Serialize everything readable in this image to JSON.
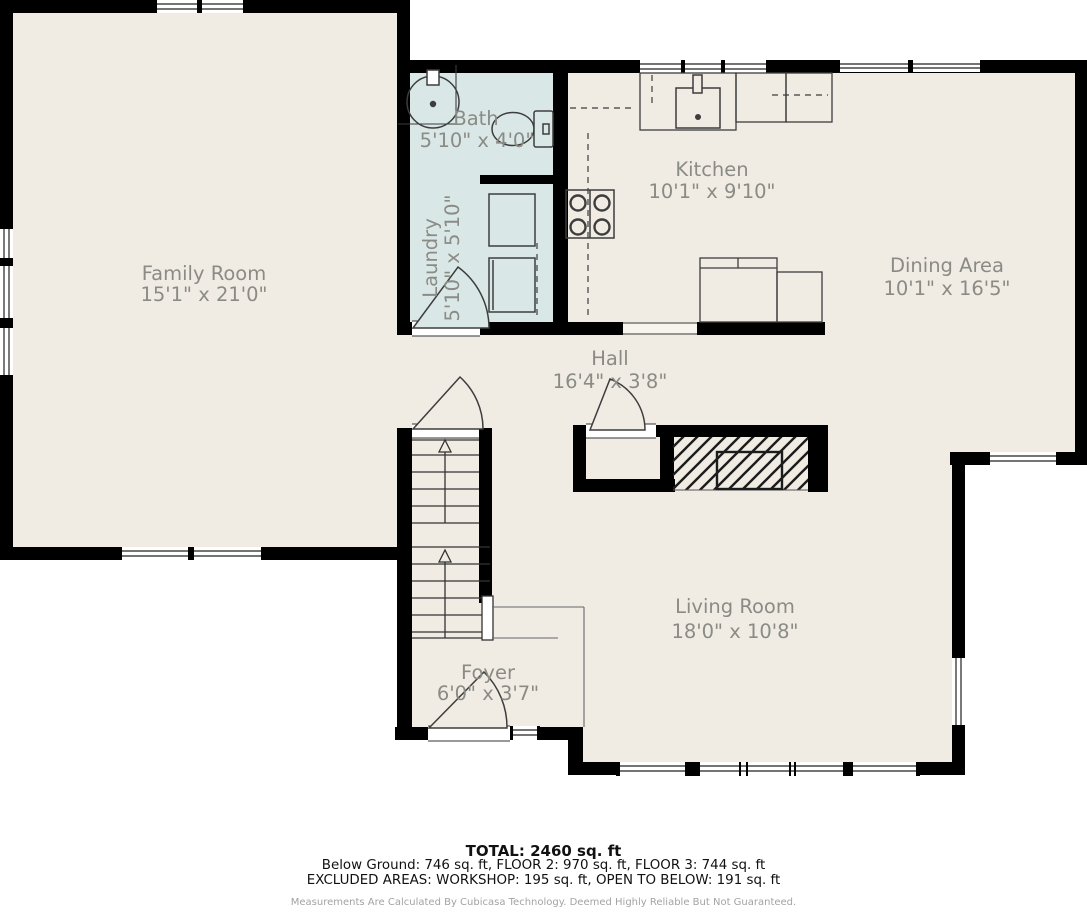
{
  "rooms": {
    "family": {
      "name": "Family Room",
      "dims": "15'1\" x 21'0\""
    },
    "bath": {
      "name": "Bath",
      "dims": "5'10\" x 4'0\""
    },
    "laundry": {
      "name": "Laundry",
      "dims": "5'10\" x 5'10\""
    },
    "kitchen": {
      "name": "Kitchen",
      "dims": "10'1\" x 9'10\""
    },
    "dining": {
      "name": "Dining Area",
      "dims": "10'1\" x 16'5\""
    },
    "hall": {
      "name": "Hall",
      "dims": "16'4\" x 3'8\""
    },
    "living": {
      "name": "Living Room",
      "dims": "18'0\" x 10'8\""
    },
    "foyer": {
      "name": "Foyer",
      "dims": "6'0\" x 3'7\""
    }
  },
  "footer": {
    "total": "TOTAL: 2460 sq. ft",
    "floors": "Below Ground: 746 sq. ft, FLOOR 2: 970 sq. ft, FLOOR 3: 744 sq. ft",
    "excluded": "EXCLUDED AREAS: WORKSHOP: 195 sq. ft, OPEN TO BELOW: 191 sq. ft",
    "disclaimer": "Measurements Are Calculated By Cubicasa Technology. Deemed Highly Reliable But Not Guaranteed."
  },
  "colors": {
    "wall": "#000000",
    "floor": "#f0ece4",
    "wet_floor": "#d9e8e7",
    "label": "#8b8b86",
    "outside": "#ffffff"
  }
}
